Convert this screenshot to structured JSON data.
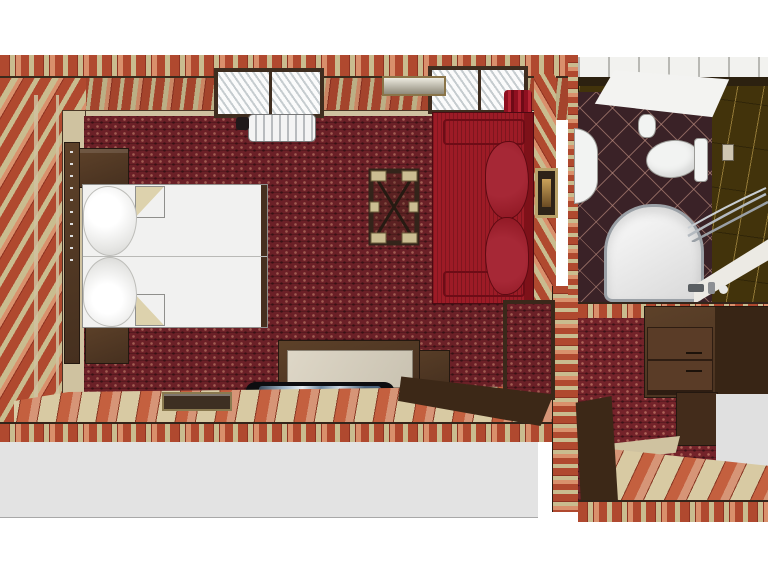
{
  "image": {
    "kind": "3d-floorplan-top-view-render",
    "description": "Top-down 3D rendering of a hotel suite: main bedroom with striped wallpaper and red patterned carpet, bathroom with dark tiles at upper right, entry hall with wardrobe at lower right",
    "width": 768,
    "height": 576
  },
  "rooms": [
    {
      "name": "bedroom",
      "floor": "dark red patterned carpet with striped runner at foot of room",
      "walls": "red and tan striped wallpaper",
      "windows": 2,
      "furniture": [
        "double bed with white duvet and two pillows",
        "headboard console",
        "nightstand top",
        "nightstand bottom",
        "radiator under window",
        "wall shelf between windows",
        "red curtain",
        "folding luggage rack",
        "red sofa with two cushions",
        "picture frame on right wall",
        "TV cabinet with light top",
        "side cabinet",
        "flat screen TV",
        "luggage tray on floor",
        "open room door"
      ]
    },
    {
      "name": "bathroom",
      "floor": "dark maroon diamond tile",
      "walls": "dark olive tile with gold joints",
      "fixtures": [
        "ceiling light panel",
        "toilet with tank",
        "toilet paper roll",
        "washbasin",
        "bathtub with curved glass shower screen",
        "vanity mirror band",
        "faucet set",
        "wall switch"
      ]
    },
    {
      "name": "entry-hall",
      "floor": "red carpet plus striped runner",
      "furniture": [
        "wardrobe with drawers",
        "lower wardrobe panel",
        "open entry door",
        "door threshold"
      ]
    }
  ],
  "palette": {
    "bg": "#ffffff",
    "carpet_base": "#6b2027",
    "stripe_red": "#b0492f",
    "stripe_dark": "#8f3322",
    "stripe_tan": "#c9bc8f",
    "stripe_salmon": "#d9906c",
    "floor_tan": "#d8caa3",
    "floor_red": "#c4603f",
    "floor_salmon": "#d69577",
    "floor_line": "#8a3a26",
    "ledge_tan": "#cfc2a0",
    "wood_dark": "#46301f",
    "wood_mid": "#5d4129",
    "bed_white": "#f1f1f0",
    "fold_tan": "#ddd2ad",
    "sofa_red": "#9d1b26",
    "sofa_dark": "#7e1119",
    "cushion_red": "#a62836",
    "bath_tile": "#3a2227",
    "olive": "#42330b",
    "white_fixture": "#f2f3f2",
    "chrome": "#9aa0a6",
    "gray_floor": "#e3e3e3",
    "tv_black": "#0d0d10"
  }
}
